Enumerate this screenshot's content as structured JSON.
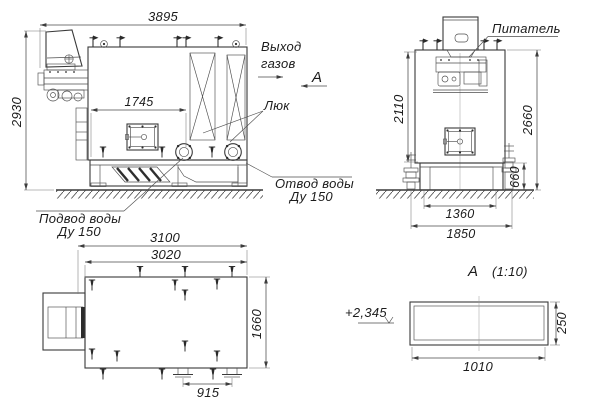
{
  "side_view": {
    "dim_width": "3895",
    "dim_height": "2930",
    "dim_hatch": "1745",
    "label_gas_line1": "Выход",
    "label_gas_line2": "газов",
    "view_letter": "А",
    "label_hatch": "Люк",
    "label_outlet_line1": "Отвод воды",
    "label_outlet_line2": "Ду 150",
    "label_supply_line1": "Подвод воды",
    "label_supply_line2": "Ду 150"
  },
  "front_view": {
    "label_feeder": "Питатель",
    "dim_body_height": "2110",
    "dim_total_height": "2660",
    "dim_base_height": "660",
    "dim_base_inner": "1360",
    "dim_base_outer": "1850"
  },
  "plan_view": {
    "dim_outer_length": "3100",
    "dim_inner_length": "3020",
    "dim_width": "1660",
    "dim_support_spacing": "915"
  },
  "detail_view": {
    "title_letter": "А",
    "title_scale": "(1:10)",
    "elevation": "+2,345",
    "dim_height": "250",
    "dim_length": "1010"
  }
}
